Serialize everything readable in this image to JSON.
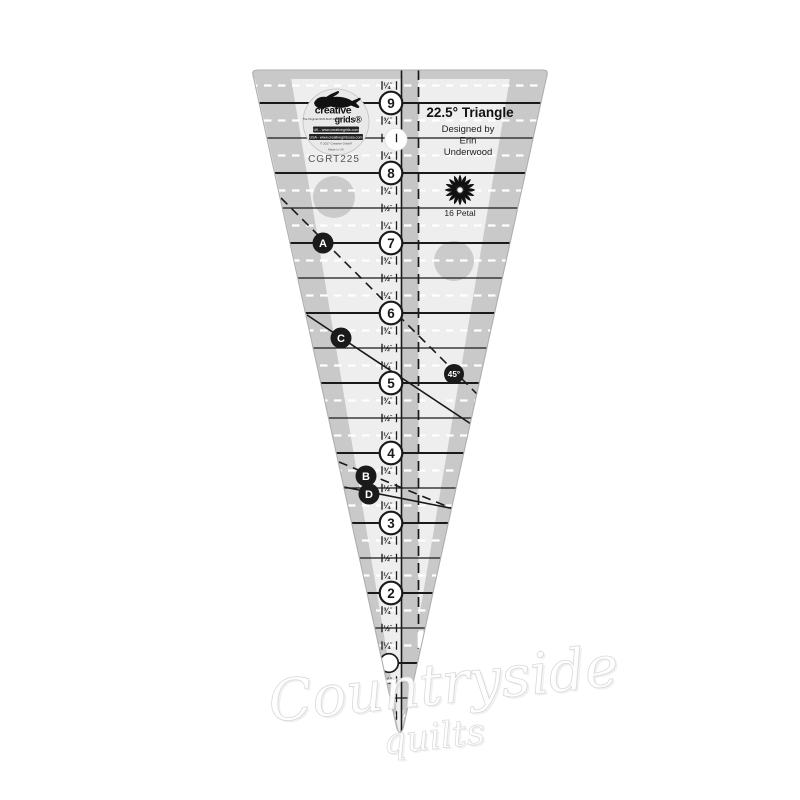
{
  "product": {
    "title": "22.5° Triangle",
    "designer_lines": [
      "Designed by",
      "Erin",
      "Underwood"
    ],
    "model": "CGRT225",
    "petal_label": "16 Petal",
    "petal_count": 16
  },
  "brand": {
    "name_top": "creative",
    "name_bottom": "grids®",
    "tagline": "The Original NON-SLIP Ruler®",
    "contact_uk": "UK - www.creativegrids.com",
    "contact_usa": "USA - www.creativegridsusa.com",
    "copyright": "© 2017 Creative Grids®",
    "made_in": "Made in UK"
  },
  "scale": {
    "unit_mark": "″",
    "rows": [
      [
        9.25,
        "¼",
        "q"
      ],
      [
        9,
        "9",
        "n"
      ],
      [
        8.75,
        "¾",
        "q"
      ],
      [
        8.5,
        "",
        "h"
      ],
      [
        8.25,
        "¼",
        "q"
      ],
      [
        8,
        "8",
        "n"
      ],
      [
        7.75,
        "¾",
        "q"
      ],
      [
        7.5,
        "½",
        "h"
      ],
      [
        7.25,
        "¼",
        "q"
      ],
      [
        7,
        "7",
        "n"
      ],
      [
        6.75,
        "¾",
        "q"
      ],
      [
        6.5,
        "½",
        "h"
      ],
      [
        6.25,
        "¼",
        "q"
      ],
      [
        6,
        "6",
        "n"
      ],
      [
        5.75,
        "¾",
        "q"
      ],
      [
        5.5,
        "½",
        "h"
      ],
      [
        5.25,
        "¼",
        "q"
      ],
      [
        5,
        "5",
        "n"
      ],
      [
        4.75,
        "¾",
        "q"
      ],
      [
        4.5,
        "½",
        "h"
      ],
      [
        4.25,
        "¼",
        "q"
      ],
      [
        4,
        "4",
        "n"
      ],
      [
        3.75,
        "¾",
        "q"
      ],
      [
        3.5,
        "½",
        "h"
      ],
      [
        3.25,
        "¼",
        "q"
      ],
      [
        3,
        "3",
        "n"
      ],
      [
        2.75,
        "¾",
        "q"
      ],
      [
        2.5,
        "½",
        "h"
      ],
      [
        2.25,
        "¼",
        "q"
      ],
      [
        2,
        "2",
        "n"
      ],
      [
        1.75,
        "¾",
        "q"
      ],
      [
        1.5,
        "½",
        "h"
      ],
      [
        1.25,
        "¼",
        "q"
      ],
      [
        1,
        "",
        "n"
      ],
      [
        0.75,
        "¾",
        "q"
      ],
      [
        0.5,
        "½",
        "h"
      ],
      [
        0.25,
        "¼",
        "q"
      ]
    ]
  },
  "angle_lines": [
    {
      "label": "A",
      "line": "dashed"
    },
    {
      "label": "C",
      "line": "solid"
    },
    {
      "label": "B",
      "line": "dashed"
    },
    {
      "label": "D",
      "line": "solid"
    },
    {
      "label": "45°",
      "line": "dashed"
    }
  ],
  "watermark": {
    "line1": "Countryside",
    "line2": "quilts"
  },
  "colors": {
    "ink": "#1a1a1a",
    "body": "#eeeeee",
    "band": "#c9c9c9",
    "center_band": "#c6c6c6",
    "grip_dot": "#cbcbcb",
    "white": "#ffffff"
  }
}
